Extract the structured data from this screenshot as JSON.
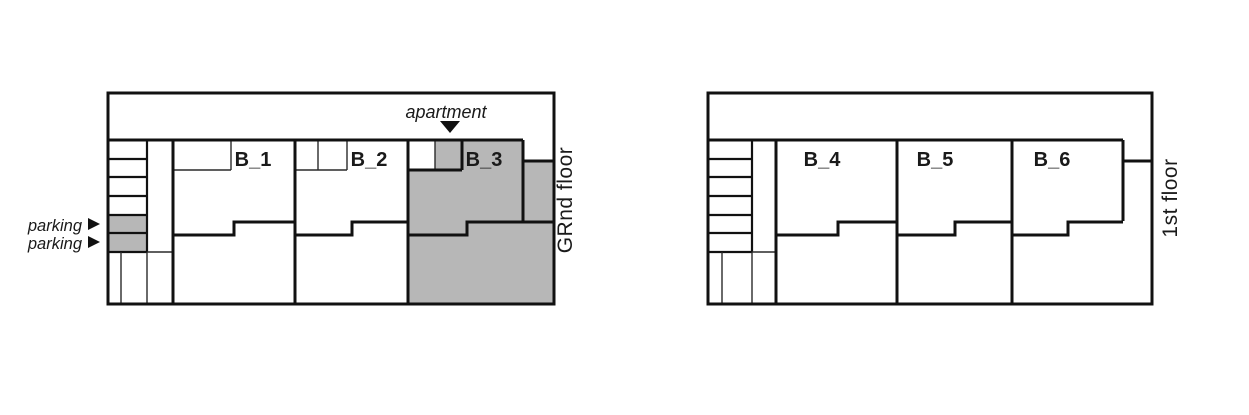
{
  "ground": {
    "floor_label": "GRnd floor",
    "apartment_label": "apartment",
    "parking_labels": [
      {
        "label": "parking"
      },
      {
        "label": "parking"
      }
    ],
    "units": [
      {
        "label": "B_1",
        "highlighted": false
      },
      {
        "label": "B_2",
        "highlighted": false
      },
      {
        "label": "B_3",
        "highlighted": true
      }
    ]
  },
  "first": {
    "floor_label": "1st floor",
    "units": [
      {
        "label": "B_4",
        "highlighted": false
      },
      {
        "label": "B_5",
        "highlighted": false
      },
      {
        "label": "B_6",
        "highlighted": false
      }
    ]
  },
  "colors": {
    "highlight_fill": "#b7b7b7",
    "line": "#111111",
    "background": "#ffffff"
  }
}
